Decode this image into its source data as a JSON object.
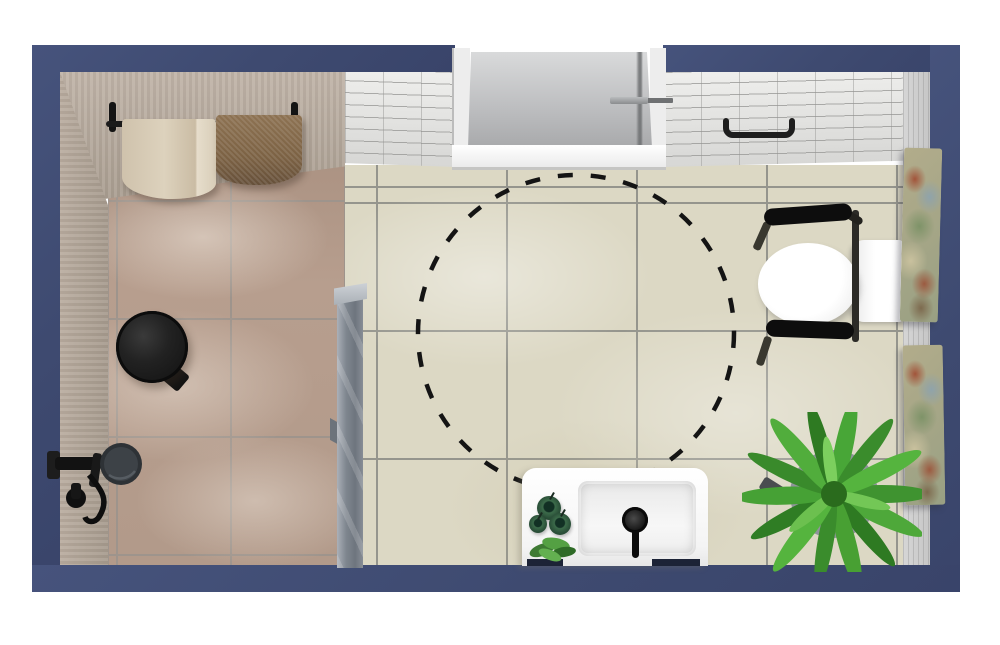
{
  "scene": {
    "title": "Accessible bathroom 3D floor plan — top view",
    "room_type": "bathroom",
    "view": "top-down 3D render"
  },
  "palette": {
    "wall_navy": "#3e4a70",
    "shower_tile_brown": "#b79e8e",
    "floor_tile_beige": "#dcd8c4",
    "grout_gray": "#95958d",
    "brick_wall_white": "#e9e9e7",
    "right_wall_gray": "#cecece",
    "fixture_black": "#141414",
    "ceramic_white": "#ffffff",
    "glass_gray": "#7f868f",
    "plant_green": "#48a033",
    "artwork_tones": [
      "#a2543a",
      "#7e9368",
      "#c9c19e",
      "#8fa3ab"
    ]
  },
  "fixtures": {
    "entry_door": {
      "label": "Entry door (closed, top wall)"
    },
    "turning_circle": {
      "label": "Wheelchair turning circle (dashed)",
      "stroke": "#141414",
      "style": "dashed"
    },
    "towel_rail": {
      "label": "Towel rail with two towels"
    },
    "towel_cream": {
      "label": "Cream towel"
    },
    "towel_brown": {
      "label": "Brown towel"
    },
    "stool": {
      "label": "Round dark wood stool"
    },
    "shower_set": {
      "label": "Black wall-mounted shower mixer set"
    },
    "glass_partition": {
      "label": "Glass shower partition panel"
    },
    "grab_rail_wall": {
      "label": "Black grab rail on top wall"
    },
    "toilet": {
      "label": "Wall-hung toilet with fold-down grab rails"
    },
    "artwork_upper": {
      "label": "Wall artwork canvas (upper)"
    },
    "artwork_lower": {
      "label": "Wall artwork canvas (lower)"
    },
    "vanity": {
      "label": "White vanity counter"
    },
    "basin": {
      "label": "Rectangular basin with black faucet"
    },
    "candles": {
      "label": "Green candle jars on counter"
    },
    "counter_plant": {
      "label": "Small counter plant"
    },
    "fern": {
      "label": "Potted fern plant"
    }
  },
  "areas": {
    "shower_area": {
      "label": "Walk-in shower area (brown tile)"
    },
    "main_floor": {
      "label": "Main bathroom floor (beige tile)"
    }
  }
}
